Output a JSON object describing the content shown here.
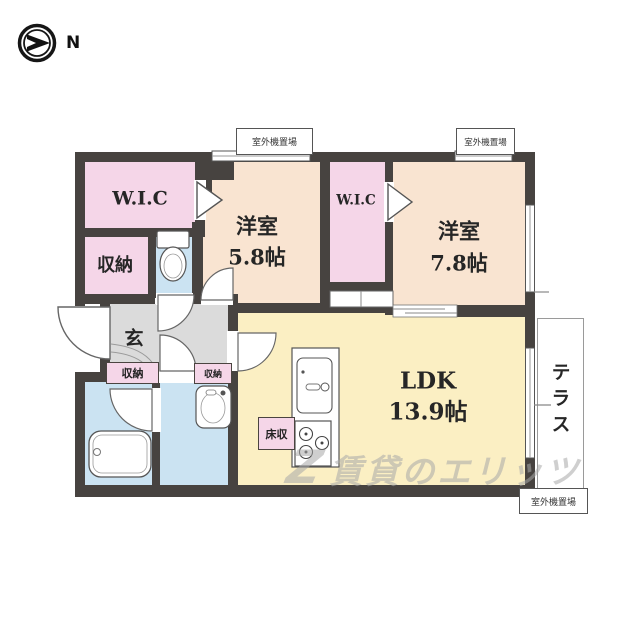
{
  "compass": {
    "north_label": "N"
  },
  "rooms": {
    "wic_left": {
      "label": "W.I.C"
    },
    "storage_left": {
      "label": "収納"
    },
    "bedroom_small": {
      "name": "洋室",
      "size": "5.8帖"
    },
    "wic_center": {
      "label": "W.I.C"
    },
    "bedroom_large": {
      "name": "洋室",
      "size": "7.8帖"
    },
    "ldk": {
      "name": "LDK",
      "size": "13.9帖"
    },
    "entrance": {
      "label": "玄"
    },
    "hall_storage": {
      "label": "収納"
    },
    "washroom_storage": {
      "label": "収納"
    },
    "floor_storage": {
      "label": "床収"
    },
    "terrace": {
      "label": "テラス"
    }
  },
  "annotations": {
    "outdoor_unit_top_left": "室外機置場",
    "outdoor_unit_top_right": "室外機置場",
    "outdoor_unit_bottom": "室外機置場"
  },
  "watermark": {
    "logo": "Z",
    "text": "賃貸のエリッツ"
  },
  "colors": {
    "wall": "#474340",
    "bedroom": "#f9e4d1",
    "closet": "#f5d6e8",
    "ldk": "#fbefc3",
    "water": "#cbe3f2",
    "hall": "#dbdbdb",
    "terrace_border": "#9a9a9a",
    "watermark": "#a9a9a9"
  }
}
